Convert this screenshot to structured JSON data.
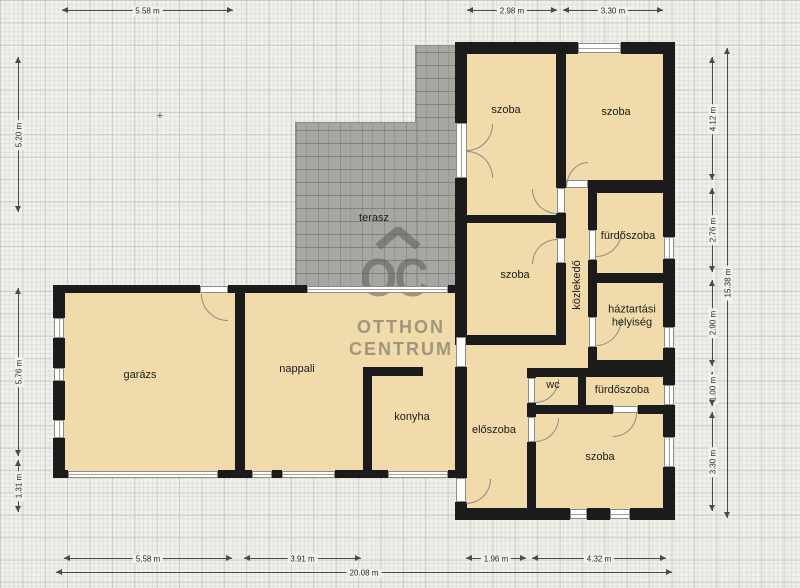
{
  "plan": {
    "rooms": {
      "szoba1": "szoba",
      "szoba2": "szoba",
      "furdoszoba1": "fürdőszoba",
      "kozlekedo": "közlekedő",
      "haztartasi": "háztartási helyiség",
      "szoba3": "szoba",
      "terasz": "terasz",
      "garazs": "garázs",
      "nappali": "nappali",
      "konyha": "konyha",
      "wc": "wc",
      "furdoszoba2": "fürdőszoba",
      "eloszoba": "előszoba",
      "szoba4": "szoba"
    },
    "dims": {
      "top1": "5.58 m",
      "top2": "2.98 m",
      "top3": "3.30 m",
      "bottom1": "5.58 m",
      "bottom2": "3.91 m",
      "bottom3": "1.96 m",
      "bottom4": "4.32 m",
      "bottom_total": "20.08 m",
      "left1": "5.20 m",
      "left2": "5.76 m",
      "left3": "1.31 m",
      "right1": "4.12 m",
      "right2": "2.76 m",
      "right3": "2.90 m",
      "right4": "1.00 m",
      "right5": "3.30 m",
      "right_total": "15.38 m"
    },
    "watermark": {
      "logo": "OC",
      "line1": "OTTHON",
      "line2": "CENTRUM"
    },
    "marker": "+",
    "colors": {
      "wall": "#1b1b1b",
      "room_fill": "#f1dbaa",
      "terrace": "#a7a6a0",
      "background": "#f1f0ea",
      "watermark_grey": "#5c5c56"
    }
  }
}
